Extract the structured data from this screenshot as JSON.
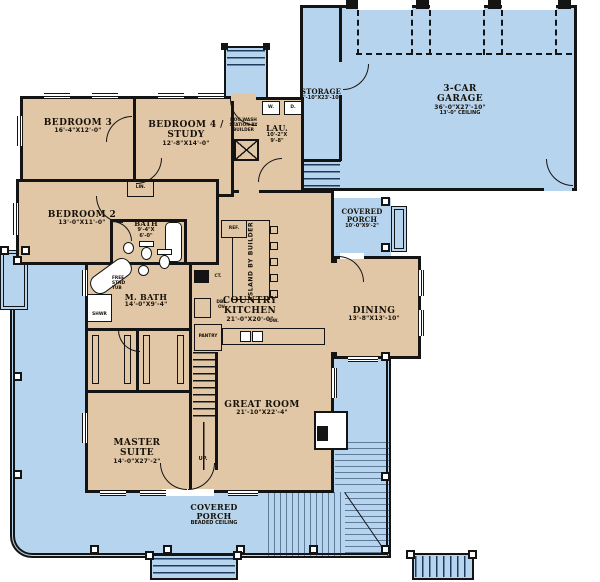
{
  "colors": {
    "porch_blue": "#b7d4ee",
    "house_tan": "#e2c7a6",
    "wall": "#141414"
  },
  "rooms": {
    "bedroom3": {
      "name": "BEDROOM 3",
      "dims": "16'-4\"X12'-0\""
    },
    "bedroom4": {
      "name": "BEDROOM 4 /",
      "name2": "STUDY",
      "dims": "12'-8\"X14'-0\""
    },
    "laundry": {
      "name": "LAU.",
      "dims": "10'-2\"X",
      "dims2": "9'-8\""
    },
    "storage": {
      "name": "STORAGE",
      "dims": "6'-10\"X23'-10\""
    },
    "garage": {
      "name": "3-CAR",
      "name2": "GARAGE",
      "dims": "36'-0\"X27'-10\"",
      "note": "13'-0\" CEILING"
    },
    "bedroom2": {
      "name": "BEDROOM 2",
      "dims": "13'-0\"X11'-0\""
    },
    "bath": {
      "name": "BATH",
      "dims": "9'-4\"X",
      "dims2": "6'-0\""
    },
    "master_bath": {
      "name": "M. BATH",
      "dims": "14'-0\"X9'-4\""
    },
    "kitchen": {
      "name": "COUNTRY",
      "name2": "KITCHEN",
      "dims": "21'-0\"X20'-0\""
    },
    "dining": {
      "name": "DINING",
      "dims": "13'-8\"X13'-10\""
    },
    "porch_upper": {
      "name": "COVERED",
      "name2": "PORCH",
      "dims": "10'-0\"X9'-2\""
    },
    "great_room": {
      "name": "GREAT ROOM",
      "dims": "21'-10\"X22'-4\""
    },
    "master_suite": {
      "name": "MASTER",
      "name2": "SUITE",
      "dims": "14'-0\"X27'-2\""
    },
    "porch_lower": {
      "name": "COVERED",
      "name2": "PORCH",
      "note": "BEADED CEILING"
    }
  },
  "fixtures": {
    "washer": "W.",
    "dryer": "D.",
    "dog_wash": [
      "DOG WASH",
      "STATION BY",
      "BUILDER"
    ],
    "linen": "LIN.",
    "refrigerator": "REF.",
    "cooktop": "CT.",
    "double_oven": [
      "DBL.",
      "OV."
    ],
    "pantry": "PANTRY",
    "dishwasher": "DW.",
    "island": "ISLAND BY BUILDER",
    "tub": [
      "FREE",
      "STND",
      "TUB"
    ],
    "shower": "SHWR",
    "stairs": "UP."
  }
}
